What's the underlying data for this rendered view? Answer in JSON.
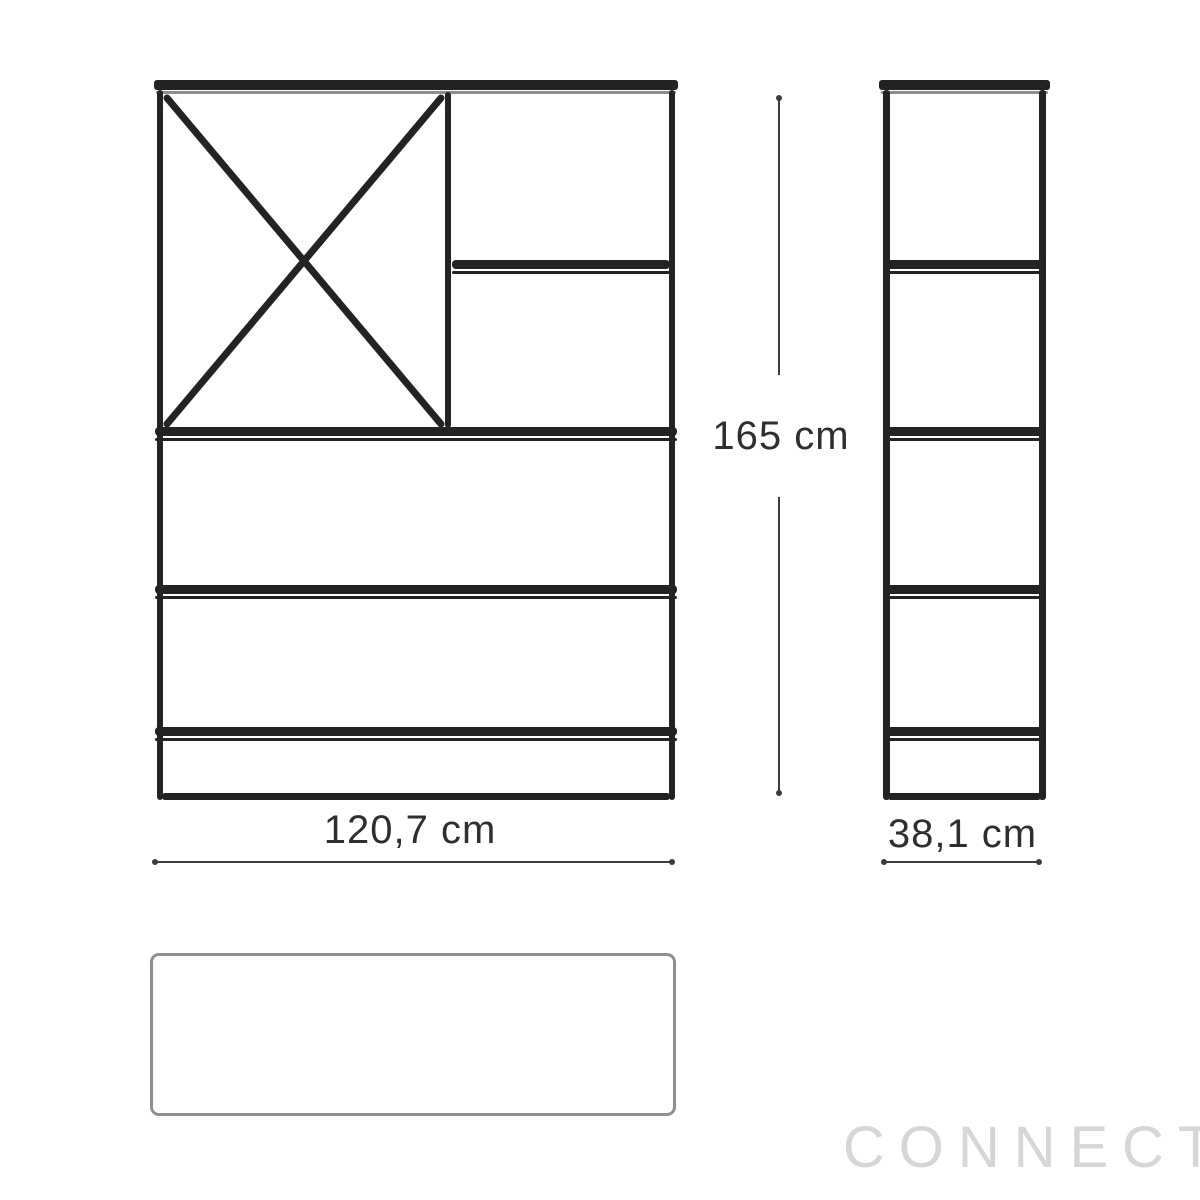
{
  "watermark": {
    "text": "CONNECT"
  },
  "dimensions": {
    "height": {
      "label": "165 cm"
    },
    "width": {
      "label": "120,7 cm"
    },
    "depth": {
      "label": "38,1 cm"
    }
  },
  "colors": {
    "line": "#232323",
    "dim": "#3c3c3c",
    "label": "#2e2e2e",
    "shadow": "#8d8d8d",
    "topview-border": "#8f8f8f",
    "watermark": "#d6d6d6",
    "background": "#ffffff"
  }
}
